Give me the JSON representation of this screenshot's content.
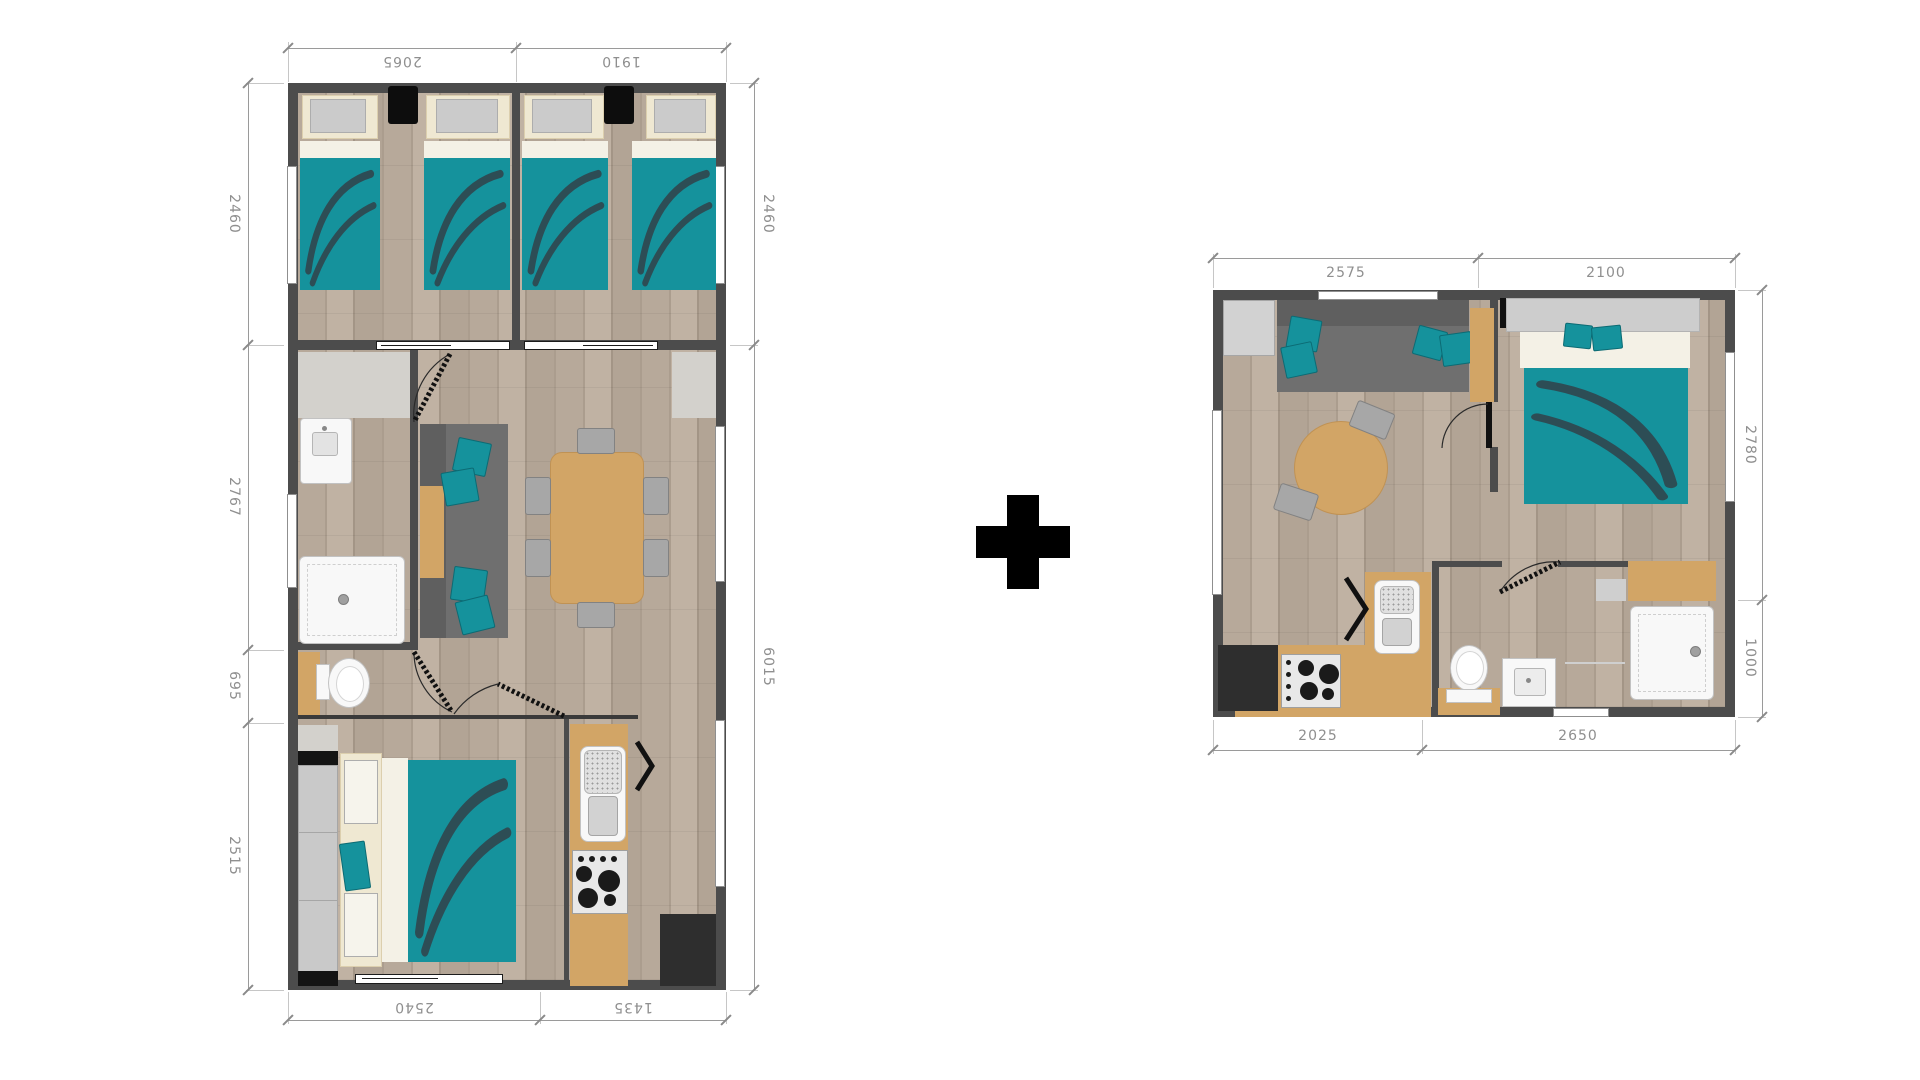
{
  "composition": {
    "separator": "+"
  },
  "left_plan": {
    "dim_top": [
      "2065",
      "1910"
    ],
    "dim_left": [
      "2460",
      "2767",
      "695",
      "2515"
    ],
    "dim_right": [
      "2460",
      "6015"
    ],
    "dim_bottom": [
      "2540",
      "1435"
    ]
  },
  "right_plan": {
    "dim_top": [
      "2575",
      "2100"
    ],
    "dim_right": [
      "2780",
      "1000"
    ],
    "dim_bottom": [
      "2025",
      "2650"
    ]
  },
  "colors": {
    "wall": "#4c4c4c",
    "floor_wood": "#b3a496",
    "bed_teal": "#15929c",
    "leaf_motif": "#2d4d55",
    "counter_tan": "#d2a566",
    "sofa_gray": "#6f6f6f",
    "dim_line": "#9a9a9a",
    "dim_text": "#8f8f8f",
    "plus_sign": "#000000"
  }
}
